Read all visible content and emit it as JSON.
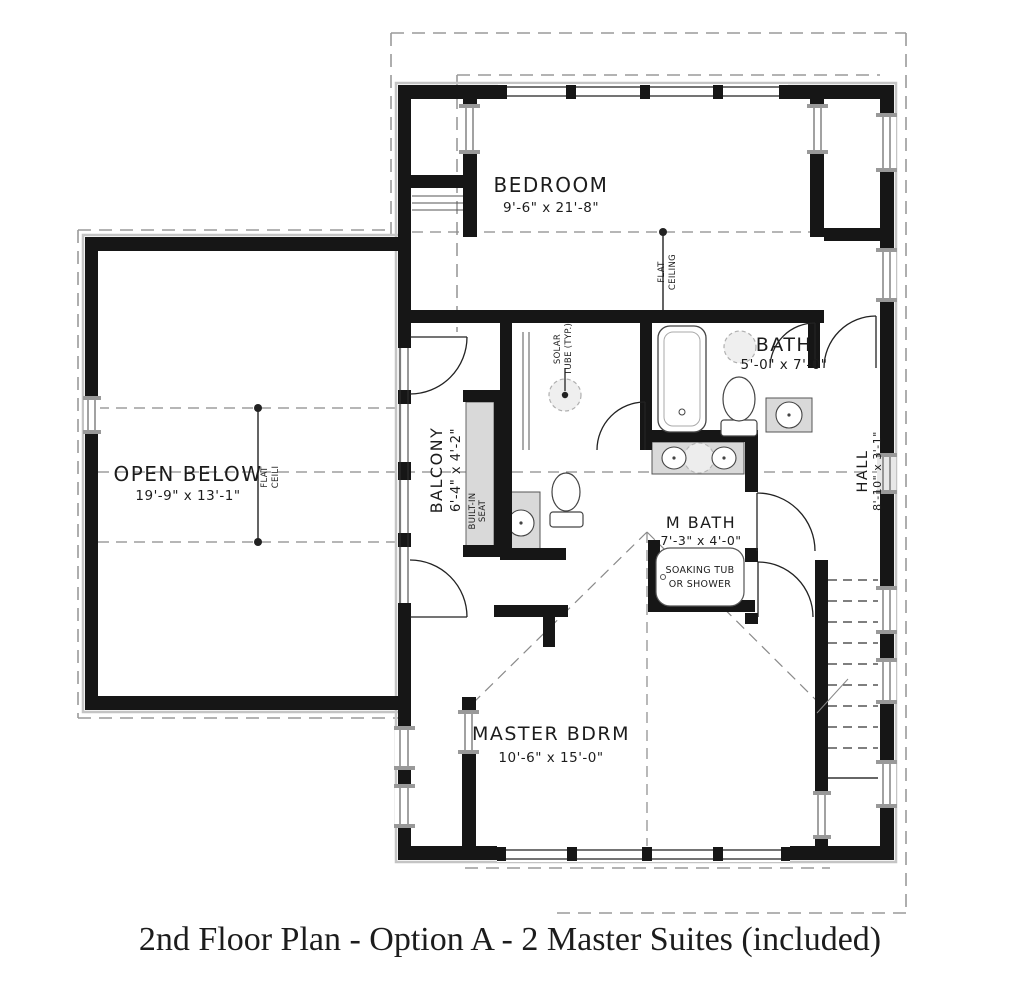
{
  "caption": "2nd Floor Plan - Option A - 2 Master Suites (included)",
  "rooms": {
    "bedroom": {
      "name": "BEDROOM",
      "dims": "9'-6\" x 21'-8\""
    },
    "bath": {
      "name": "BATH",
      "dims": "5'-0\" x 7'-0\""
    },
    "open_below": {
      "name": "OPEN BELOW",
      "dims": "19'-9\" x 13'-1\""
    },
    "balcony": {
      "name": "BALCONY",
      "dims": "6'-4\" x 4'-2\""
    },
    "m_bath": {
      "name": "M BATH",
      "dims": "7'-3\" x 4'-0\""
    },
    "hall": {
      "name": "HALL",
      "dims": "8'-10\" x 3'-1\""
    },
    "master_bdrm": {
      "name": "MASTER BDRM",
      "dims": "10'-6\" x 15'-0\""
    }
  },
  "annotations": {
    "flat_ceiling": {
      "line1": "FLAT",
      "line2": "CEILING"
    },
    "flat_ceili": {
      "line1": "FLAT",
      "line2": "CEILI"
    },
    "solar_tube": {
      "line1": "SOLAR",
      "line2": "TUBE (TYP.)"
    },
    "built_in_seat": {
      "line1": "BUILT-IN",
      "line2": "SEAT"
    },
    "soaking_tub": {
      "line1": "SOAKING TUB",
      "line2": "OR SHOWER"
    }
  },
  "colors": {
    "wall": "#161616",
    "fixture_fill": "#d9d9d9",
    "dash_gray": "#999999",
    "text": "#1c1c1c"
  }
}
